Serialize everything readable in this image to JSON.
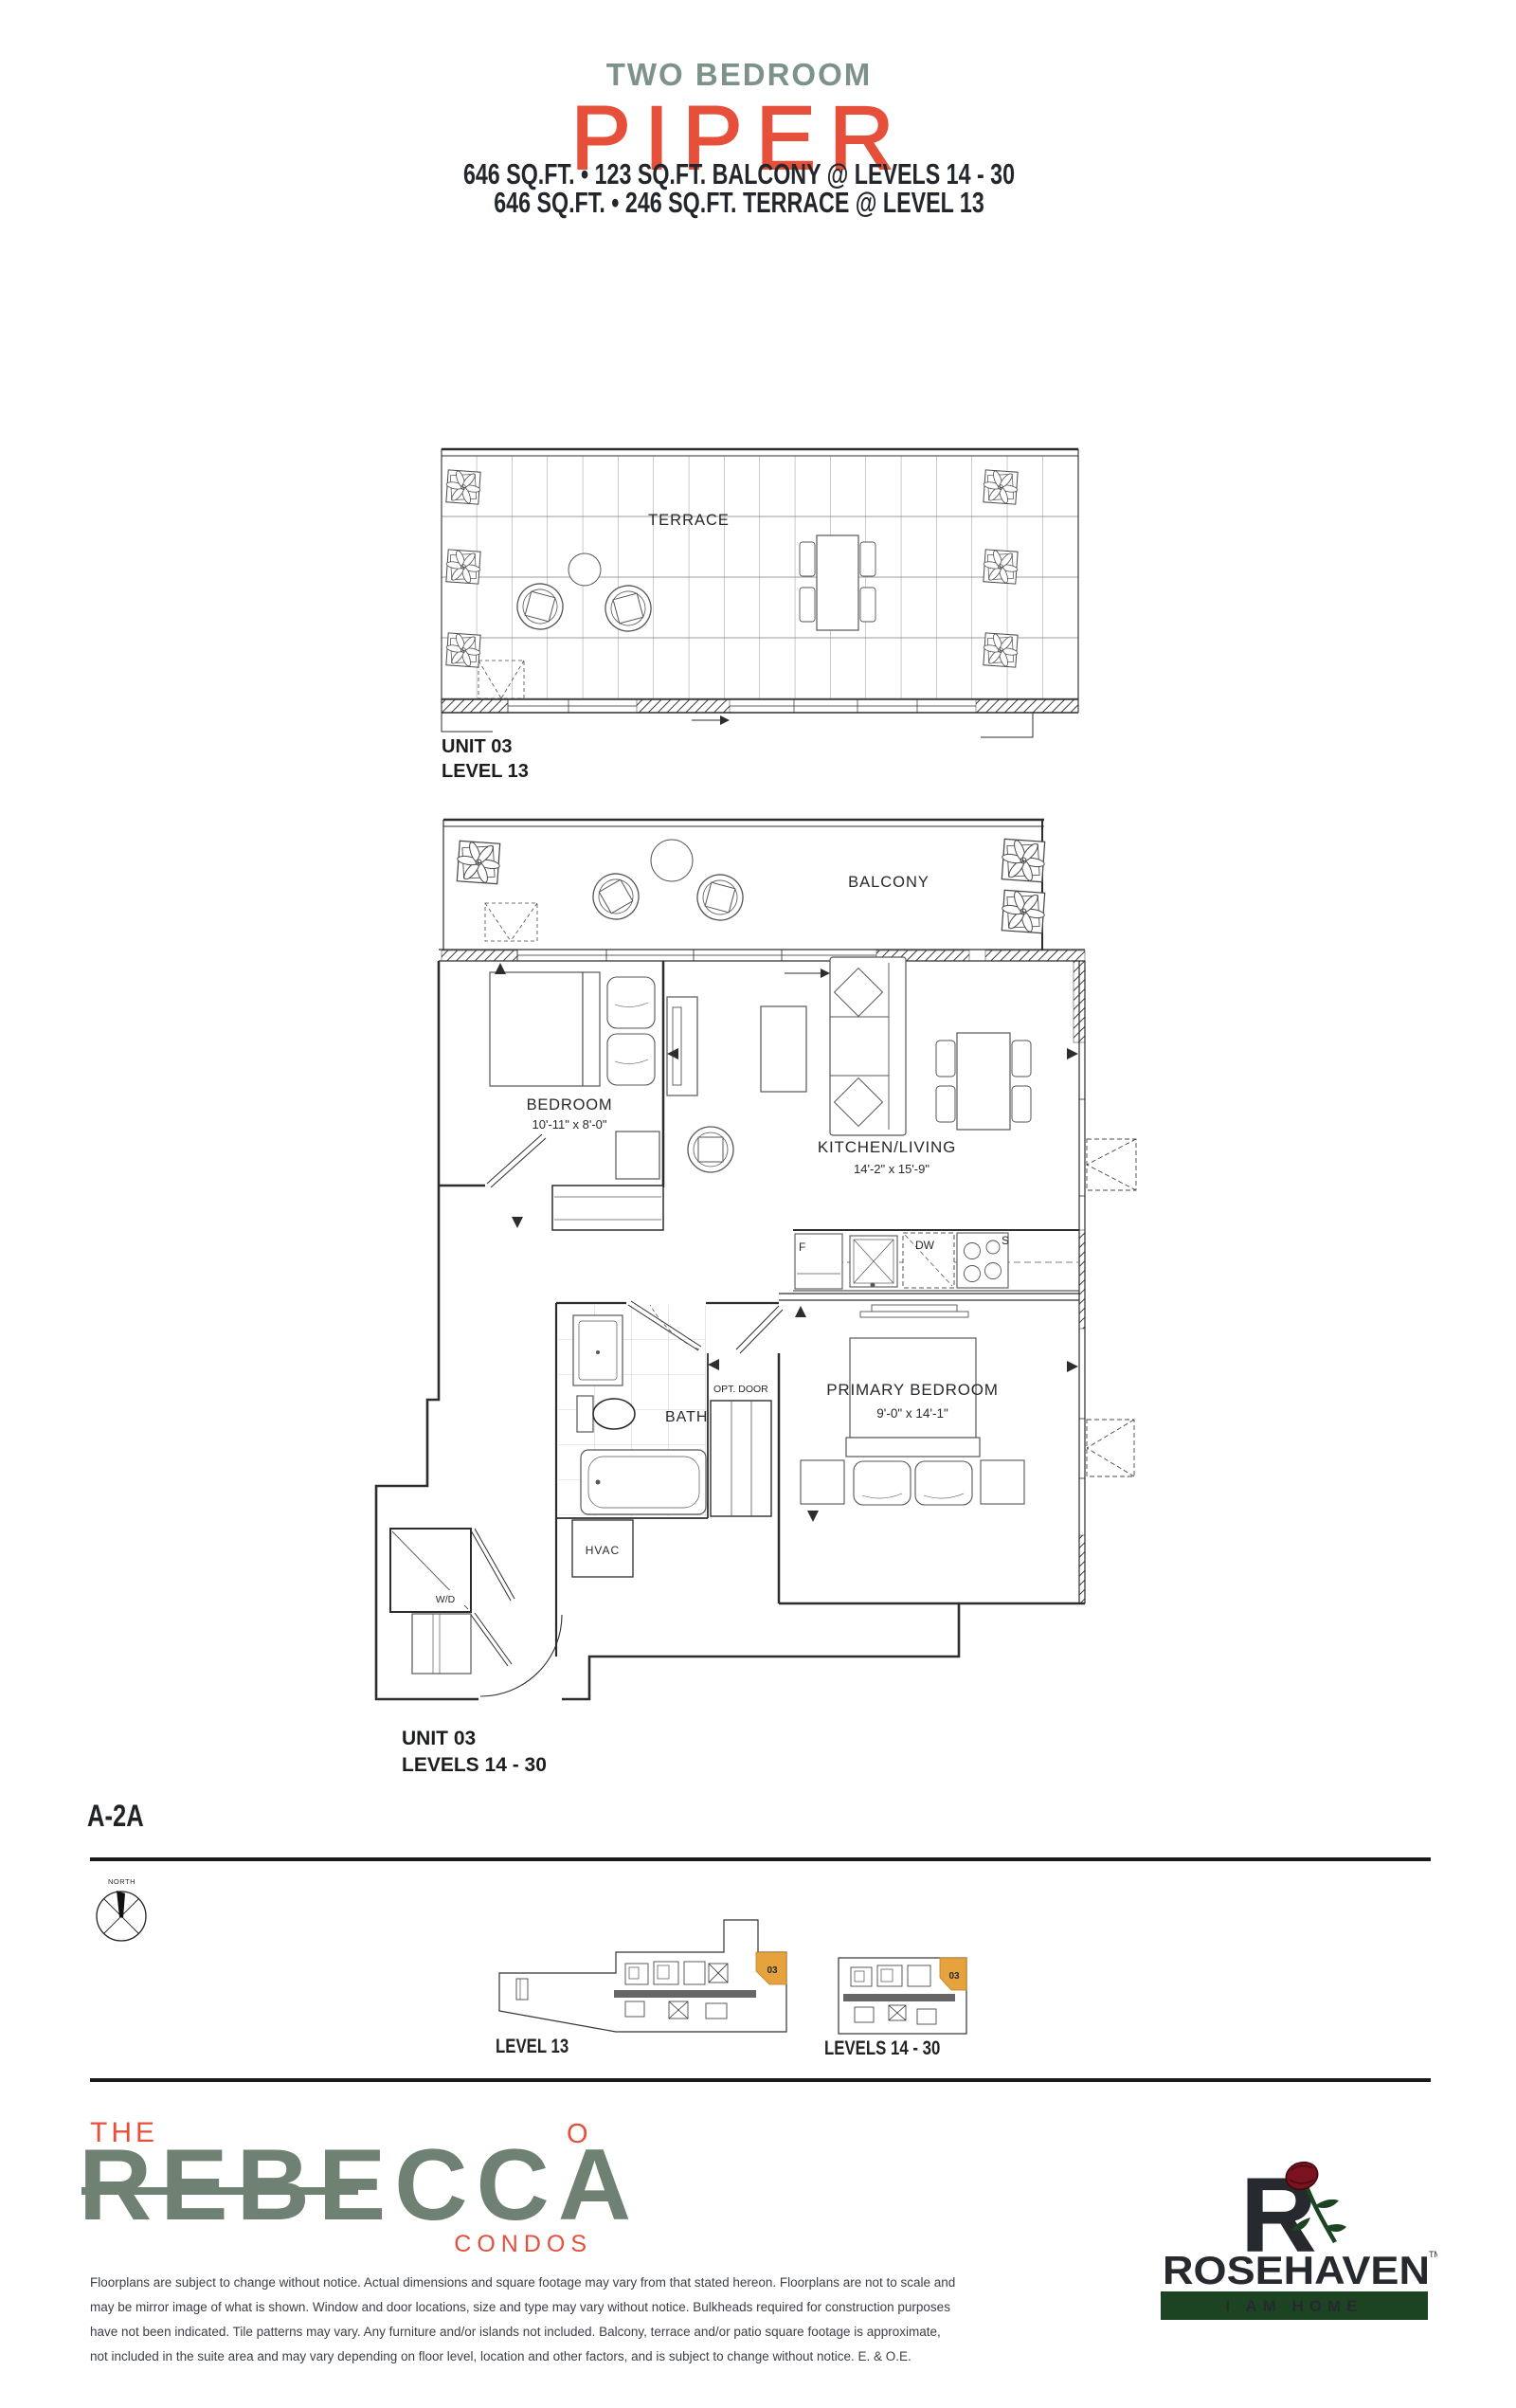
{
  "header": {
    "type_label": "TWO BEDROOM",
    "plan_name": "PIPER",
    "spec_line_1": "646 SQ.FT. • 123 SQ.FT. BALCONY @ LEVELS 14 - 30",
    "spec_line_2": "646 SQ.FT. • 246 SQ.FT. TERRACE @ LEVEL 13",
    "name_color": "#e6503b",
    "type_color": "#7d9289"
  },
  "terrace_plan": {
    "room_label": "TERRACE",
    "unit_label": "UNIT 03",
    "level_label": "LEVEL 13"
  },
  "main_plan": {
    "balcony_label": "BALCONY",
    "bedroom_label": "BEDROOM",
    "bedroom_dims": "10'-11\" x 8'-0\"",
    "kitchen_living_label": "KITCHEN/LIVING",
    "kitchen_living_dims": "14'-2\" x 15'-9\"",
    "primary_label": "PRIMARY BEDROOM",
    "primary_dims": "9'-0\" x 14'-1\"",
    "bath_label": "BATH",
    "opt_door_label": "OPT. DOOR",
    "hvac_label": "HVAC",
    "wd_label": "W/D",
    "fridge_letter": "F",
    "dishwasher_letter": "DW",
    "stove_letter": "S",
    "unit_label": "UNIT 03",
    "level_label": "LEVELS 14 - 30"
  },
  "plan_code": "A-2A",
  "compass": {
    "north_label": "NORTH"
  },
  "keyplans": {
    "highlight_color": "#e6a33d",
    "level13": {
      "label": "LEVEL 13",
      "unit_number": "03"
    },
    "levels14_30": {
      "label": "LEVELS 14 - 30",
      "unit_number": "03"
    }
  },
  "rebecca_logo": {
    "the": "THE",
    "name": "REBECCA",
    "o_mark": "O",
    "condos": "CONDOS",
    "red": "#e6503b",
    "green": "#6f8172"
  },
  "rosehaven_logo": {
    "name": "ROSEHAVEN",
    "trademark": "TM",
    "tagline": "I AM HOME",
    "green": "#1c4422"
  },
  "disclaimer": {
    "lines": [
      "Floorplans are subject to change without notice. Actual dimensions and square footage may vary from that stated hereon. Floorplans are not to scale and",
      "may be mirror image of what is shown. Window and door locations, size and type may vary without notice. Bulkheads required for construction purposes",
      "have not been indicated. Tile patterns may vary. Any furniture and/or islands not included. Balcony, terrace and/or patio square footage is approximate,",
      "not included in the suite area and may vary depending on floor level, location and other factors, and is subject to change without notice. E. & O.E."
    ]
  }
}
